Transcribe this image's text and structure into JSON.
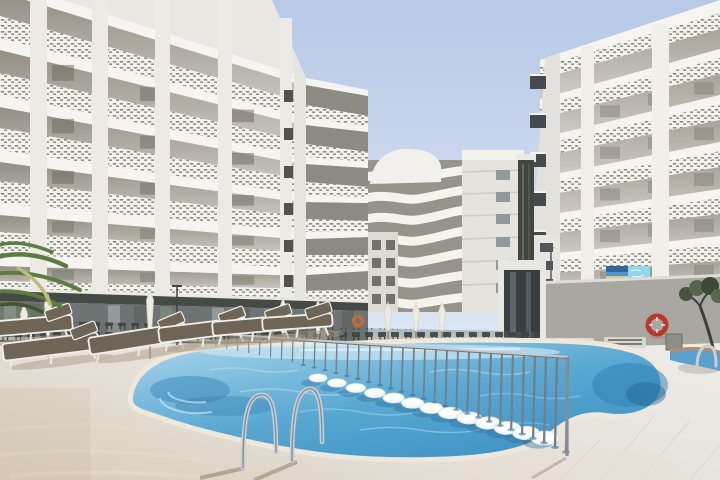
{
  "meta": {
    "domain": "Natural-Image",
    "description": "Sunny courtyard of a large white resort hotel: three multi-storey apartment blocks with perforated balcony railings surround a free-form blue swimming pool; a thin metal safety fence and a row of white in-water stools cross the pool, chrome entry ladders stand at the near edge, and the foreground deck holds sun loungers, closed white parasols and a palm.",
    "scene": "hotel pool courtyard",
    "lighting": "bright midday sun, clear sky"
  },
  "colors": {
    "sky_top": "#b7c9e7",
    "sky_horizon": "#dbe6f3",
    "building_face": "#e9e7e2",
    "building_slab": "#f5f4f0",
    "building_shadow": "#989288",
    "awning": "#454a44",
    "glass_terrace": "#6e7476",
    "concrete_wall": "#a9a7a1",
    "deck_warm": "#d8cbb6",
    "deck_mid": "#e4e0d8",
    "deck_light": "#eceae6",
    "pool_light": "#a3d2e8",
    "pool_mid": "#58a8d2",
    "pool_deep": "#3b90c0",
    "coping": "#bf8a63",
    "fence_metal": "#777d82",
    "stool_white": "#f4f8f9",
    "chrome": "#c9cfd4",
    "cushion": "#6e6557",
    "parasol": "#edebdf",
    "palm_green": "#5d7c42",
    "lifebuoy_red": "#b9382b",
    "lifebuoy_orange": "#cf6a36",
    "banner_sea": "#35649a",
    "banner_cyan": "#8fd8e8",
    "dark_tower": "#41463f"
  },
  "objects": {
    "buildings": [
      {
        "id": "left-block",
        "position": "left",
        "visible_floors": 7,
        "style": "white grid facade with perforated balcony railings"
      },
      {
        "id": "middle-block",
        "position": "center background",
        "visible_floors": 7,
        "style": "curved wavy balcony fronts with dark service tower"
      },
      {
        "id": "right-block",
        "position": "right",
        "visible_floors": 7,
        "style": "white grid facade, perforated railings, small banner on first-floor railing"
      }
    ],
    "pool": {
      "shape": "free-form kidney",
      "water": "clear blue",
      "edge": "terracotta brick coping",
      "in_water_stools": 13,
      "steps": "shallow arc steps at left end"
    },
    "fence": {
      "type": "thin metal pool safety fence",
      "posts": 34,
      "runs": "diagonally across the water"
    },
    "ladders": 3,
    "parasols_closed": 8,
    "sun_loungers_foreground": 6,
    "sun_loungers_right": 2,
    "lifebuoys": 2,
    "palm_trees": 1,
    "banner": {
      "location": "right block first-floor railing",
      "content": "small beach-photo banner with a light blue panel (text not legible)"
    }
  }
}
